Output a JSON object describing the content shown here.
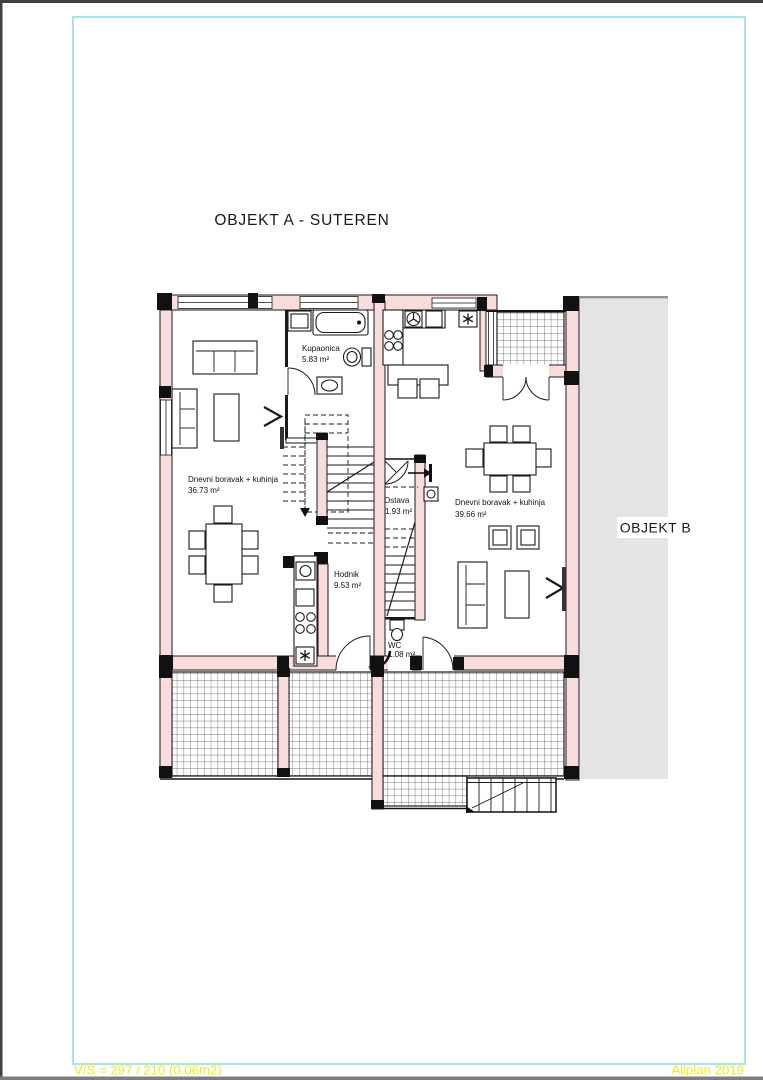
{
  "page": {
    "title": "OBJEKT A - SUTEREN",
    "footer_left": "V/Š = 297 / 210 (0.06m2)",
    "footer_right": "Allplan 2019"
  },
  "theme": {
    "wall": "#f8dcdc",
    "frame": "#a8e4e7",
    "annot": "#ecec1e",
    "grayb": "#e4e4e4"
  },
  "plan": {
    "objekt_b_label": "OBJEKT B",
    "rooms": [
      {
        "name": "Kupaonica",
        "area": "5.83 m²"
      },
      {
        "name": "Dnevni boravak + kuhinja",
        "area": "36.73 m²"
      },
      {
        "name": "Ostava",
        "area": "1.93 m²"
      },
      {
        "name": "Dnevni boravak + kuhinja",
        "area": "39.66 m²"
      },
      {
        "name": "Hodnik",
        "area": "9.53 m²"
      },
      {
        "name": "WC",
        "area": "1.08 m²"
      }
    ]
  }
}
